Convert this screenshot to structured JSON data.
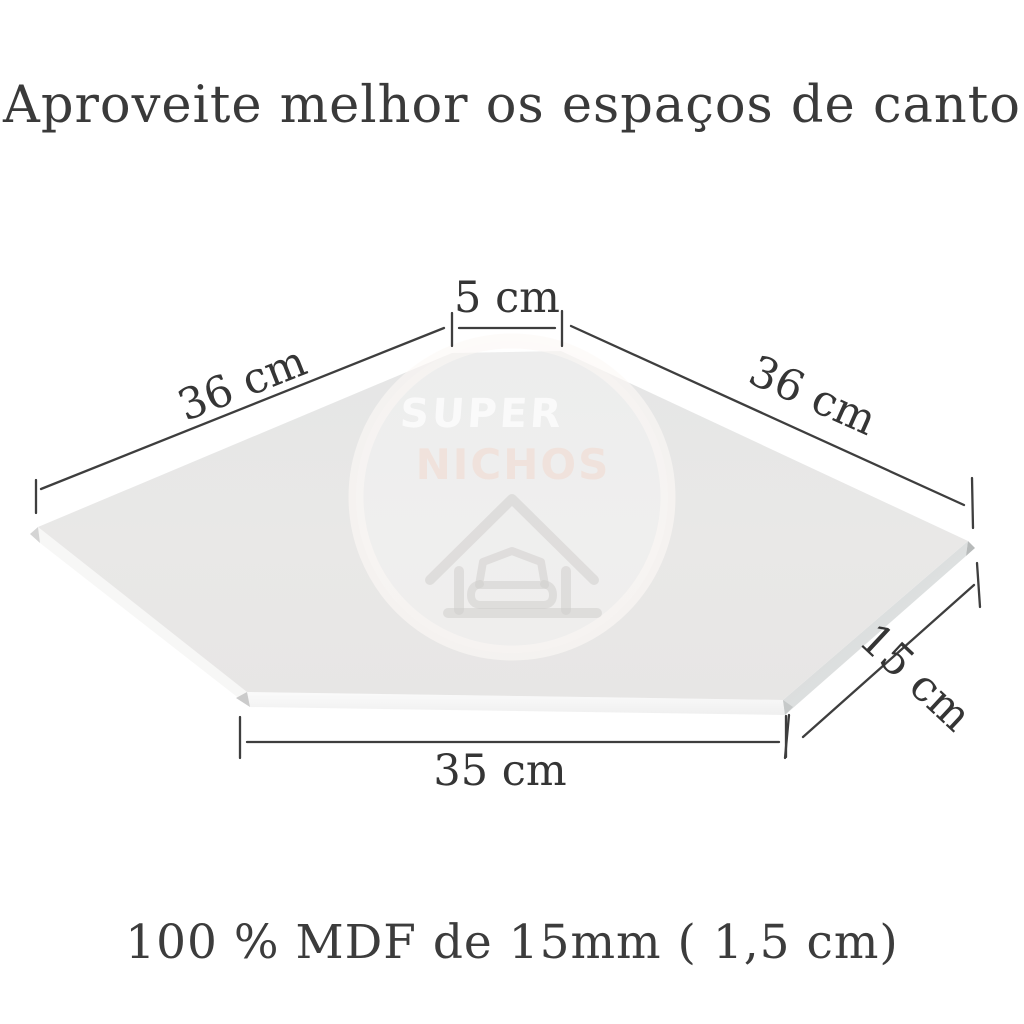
{
  "header": {
    "title": "Aproveite melhor os espaços de canto"
  },
  "footer": {
    "note": "100 % MDF de 15mm ( 1,5 cm)"
  },
  "diagram": {
    "dimensions": {
      "top": "5 cm",
      "left": "36 cm",
      "right": "36 cm",
      "depth": "15 cm",
      "bottom": "35 cm"
    },
    "watermark": {
      "line1": "SUPER",
      "line2": "NICHOS",
      "icon": "house-armchair-icon"
    }
  },
  "colors": {
    "background": "#ffffff",
    "heading_text": "#3a3a3a",
    "dimension_text": "#353535",
    "dimension_line": "#3e3e3e",
    "shelf_top": "#e9e8e7",
    "shelf_front_edge": "#f4f4f4",
    "shelf_right_edge": "#d6d9d9",
    "watermark_pink": "#f2ded6"
  }
}
